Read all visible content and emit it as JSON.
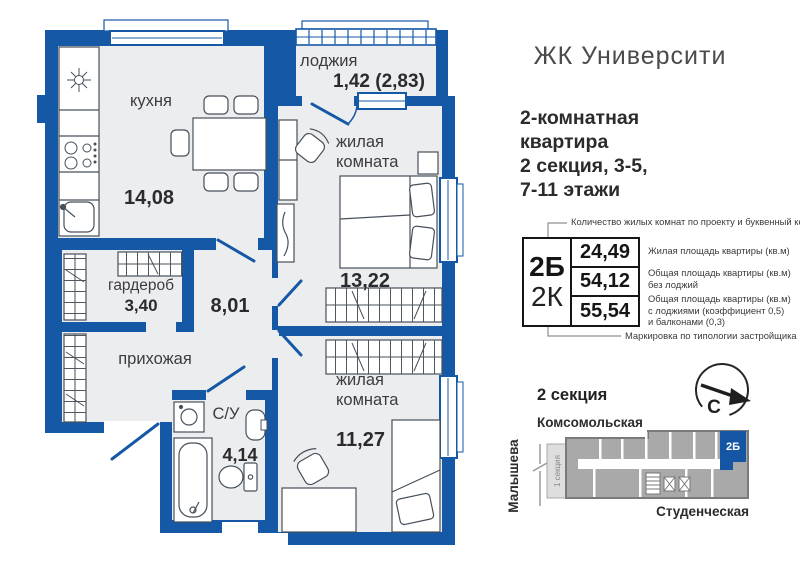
{
  "project": {
    "title": "ЖК Университи",
    "subtitle_lines": [
      "2-комнатная",
      "квартира",
      "2 секция, 3-5,",
      "7-11 этажи"
    ]
  },
  "legend": {
    "top_note": "Количество жилых комнат по проекту и буквенный код",
    "bottom_note": "Маркировка по типологии застройщика",
    "code_primary": "2Б",
    "code_secondary": "2К",
    "rows": [
      {
        "value": "24,49",
        "lines": [
          "Жилая площадь квартиры (кв.м)",
          "",
          ""
        ]
      },
      {
        "value": "54,12",
        "lines": [
          "Общая площадь квартиры (кв.м)",
          "без лоджий",
          ""
        ]
      },
      {
        "value": "55,54",
        "lines": [
          "Общая площадь квартиры (кв.м)",
          "с лоджиями (коэффициент 0,5)",
          "и балконами (0,3)"
        ]
      }
    ]
  },
  "plan": {
    "rooms": {
      "kitchen": {
        "name": "кухня",
        "area": "14,08"
      },
      "loggia": {
        "name": "лоджия",
        "area": "1,42 (2,83)"
      },
      "bedroom1": {
        "name_line1": "жилая",
        "name_line2": "комната",
        "area": "13,22"
      },
      "wardrobe": {
        "name": "гардероб",
        "area": "3,40"
      },
      "hallway": {
        "area": "8,01"
      },
      "entry": {
        "name": "прихожая"
      },
      "bathroom": {
        "name": "С/У",
        "area": "4,14"
      },
      "bedroom2": {
        "name_line1": "жилая",
        "name_line2": "комната",
        "area": "11,27"
      }
    }
  },
  "map": {
    "section_title": "2 секция",
    "street_top": "Комсомольская",
    "street_left": "Малышева",
    "street_bottom": "Студенческая",
    "section1_label": "1 секция",
    "unit_label": "2Б",
    "compass_letter": "С"
  },
  "colors": {
    "wall_blue": "#1558a6",
    "floor": "#ecedef",
    "building_gray": "#a9a9a9",
    "unit_blue": "#1456a4",
    "callout_gray": "#8f8f8f"
  }
}
